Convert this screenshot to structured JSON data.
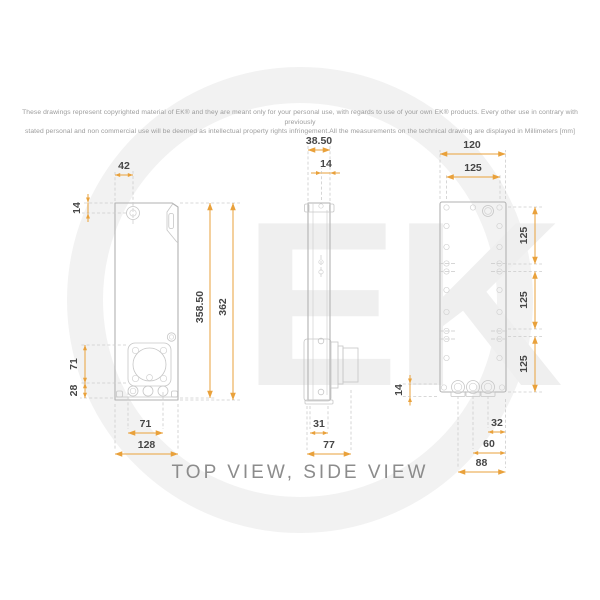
{
  "disclaimer": {
    "line1": "These drawings represent copyrighted material of EK® and they are meant only for your personal use, with regards to use of  your own EK® products. Every other use in contrary with previously",
    "line2": "stated personal and non commercial use will be deemed as intellectual property rights infringement.All the measurements on the technical drawing are displayed in Millimeters [mm]"
  },
  "watermark": {
    "logo_text": "EK"
  },
  "footer": {
    "title": "TOP VIEW, SIDE VIEW"
  },
  "colors": {
    "dimension_line": "#E9A13B",
    "dimension_text": "#464646",
    "drawing_outline": "#B2B2B2",
    "watermark_gray": "#F1F1F1",
    "disclaimer_text": "#9C9C9C",
    "title_text": "#8C8C8C"
  },
  "views": {
    "top_view": {
      "dims": {
        "port_offset_x": "42",
        "port_offset_y": "14",
        "pump_mount_height": "71",
        "pump_mount_bottom": "28",
        "inner_length": "358.50",
        "overall_length": "362",
        "pump_mount_width": "71",
        "overall_width": "128"
      }
    },
    "side_view": {
      "dims": {
        "body_depth": "38.50",
        "lid_depth": "14",
        "pump_offset": "31",
        "overall_depth": "77"
      }
    },
    "back_view": {
      "dims": {
        "overall_width": "120",
        "hole_pitch_top": "125",
        "hole_pitch_1": "125",
        "hole_pitch_2": "125",
        "hole_pitch_3": "125",
        "port_edge_offset": "14",
        "port_1_offset": "32",
        "port_2_offset": "60",
        "port_3_offset": "88"
      }
    }
  }
}
